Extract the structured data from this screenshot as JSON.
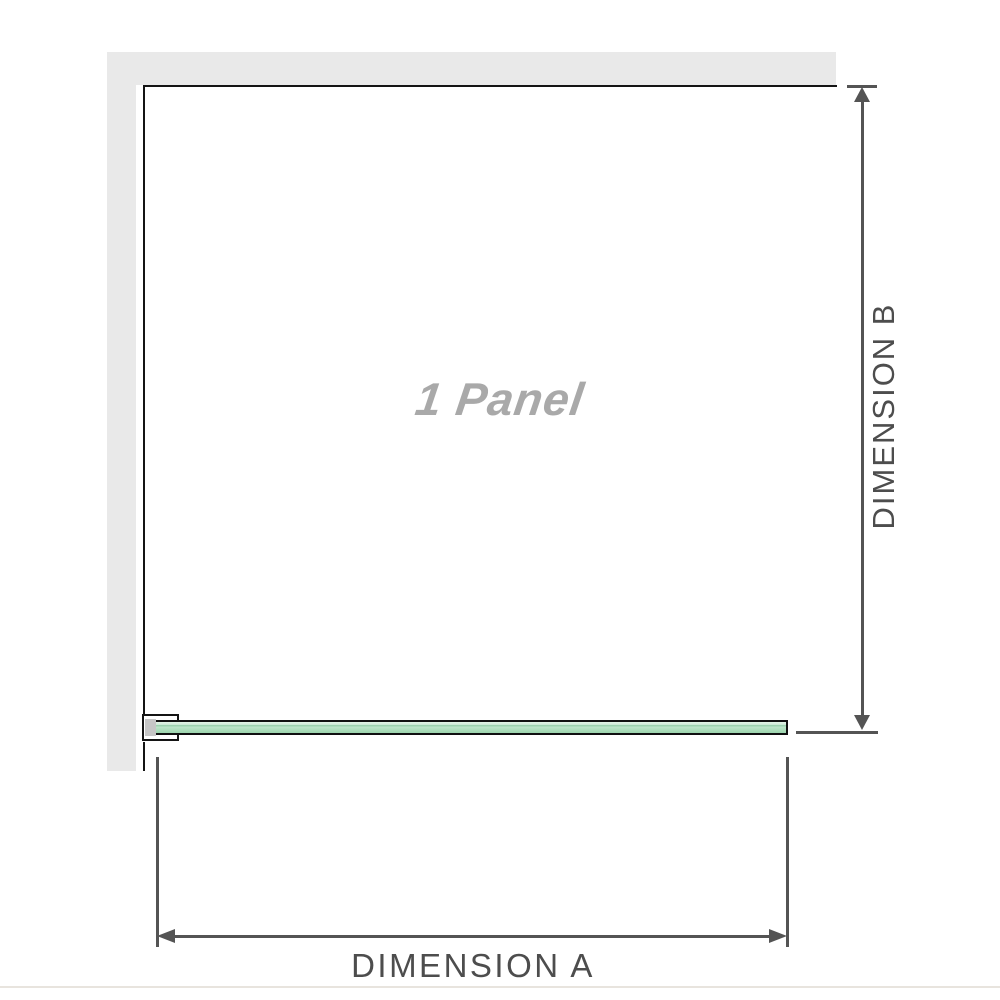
{
  "diagram": {
    "panel_label": "1 Panel",
    "dimensions": {
      "a_label": "DIMENSION A",
      "b_label": "DIMENSION B"
    }
  },
  "colors": {
    "wall": "#e9e9e9",
    "outline": "#141414",
    "dimension_line": "#545454",
    "dimension_text": "#4d4d4d",
    "panel_label": "#a9a9a9",
    "glass_border": "#101010",
    "glass_light": "#e3f3e7",
    "glass_mid": "#abdcba",
    "glass_deep": "#8fcaa4",
    "bracket_fill": "#ffffff",
    "bracket_shadow": "#c6c6c6",
    "baseline": "#e8e4de"
  }
}
